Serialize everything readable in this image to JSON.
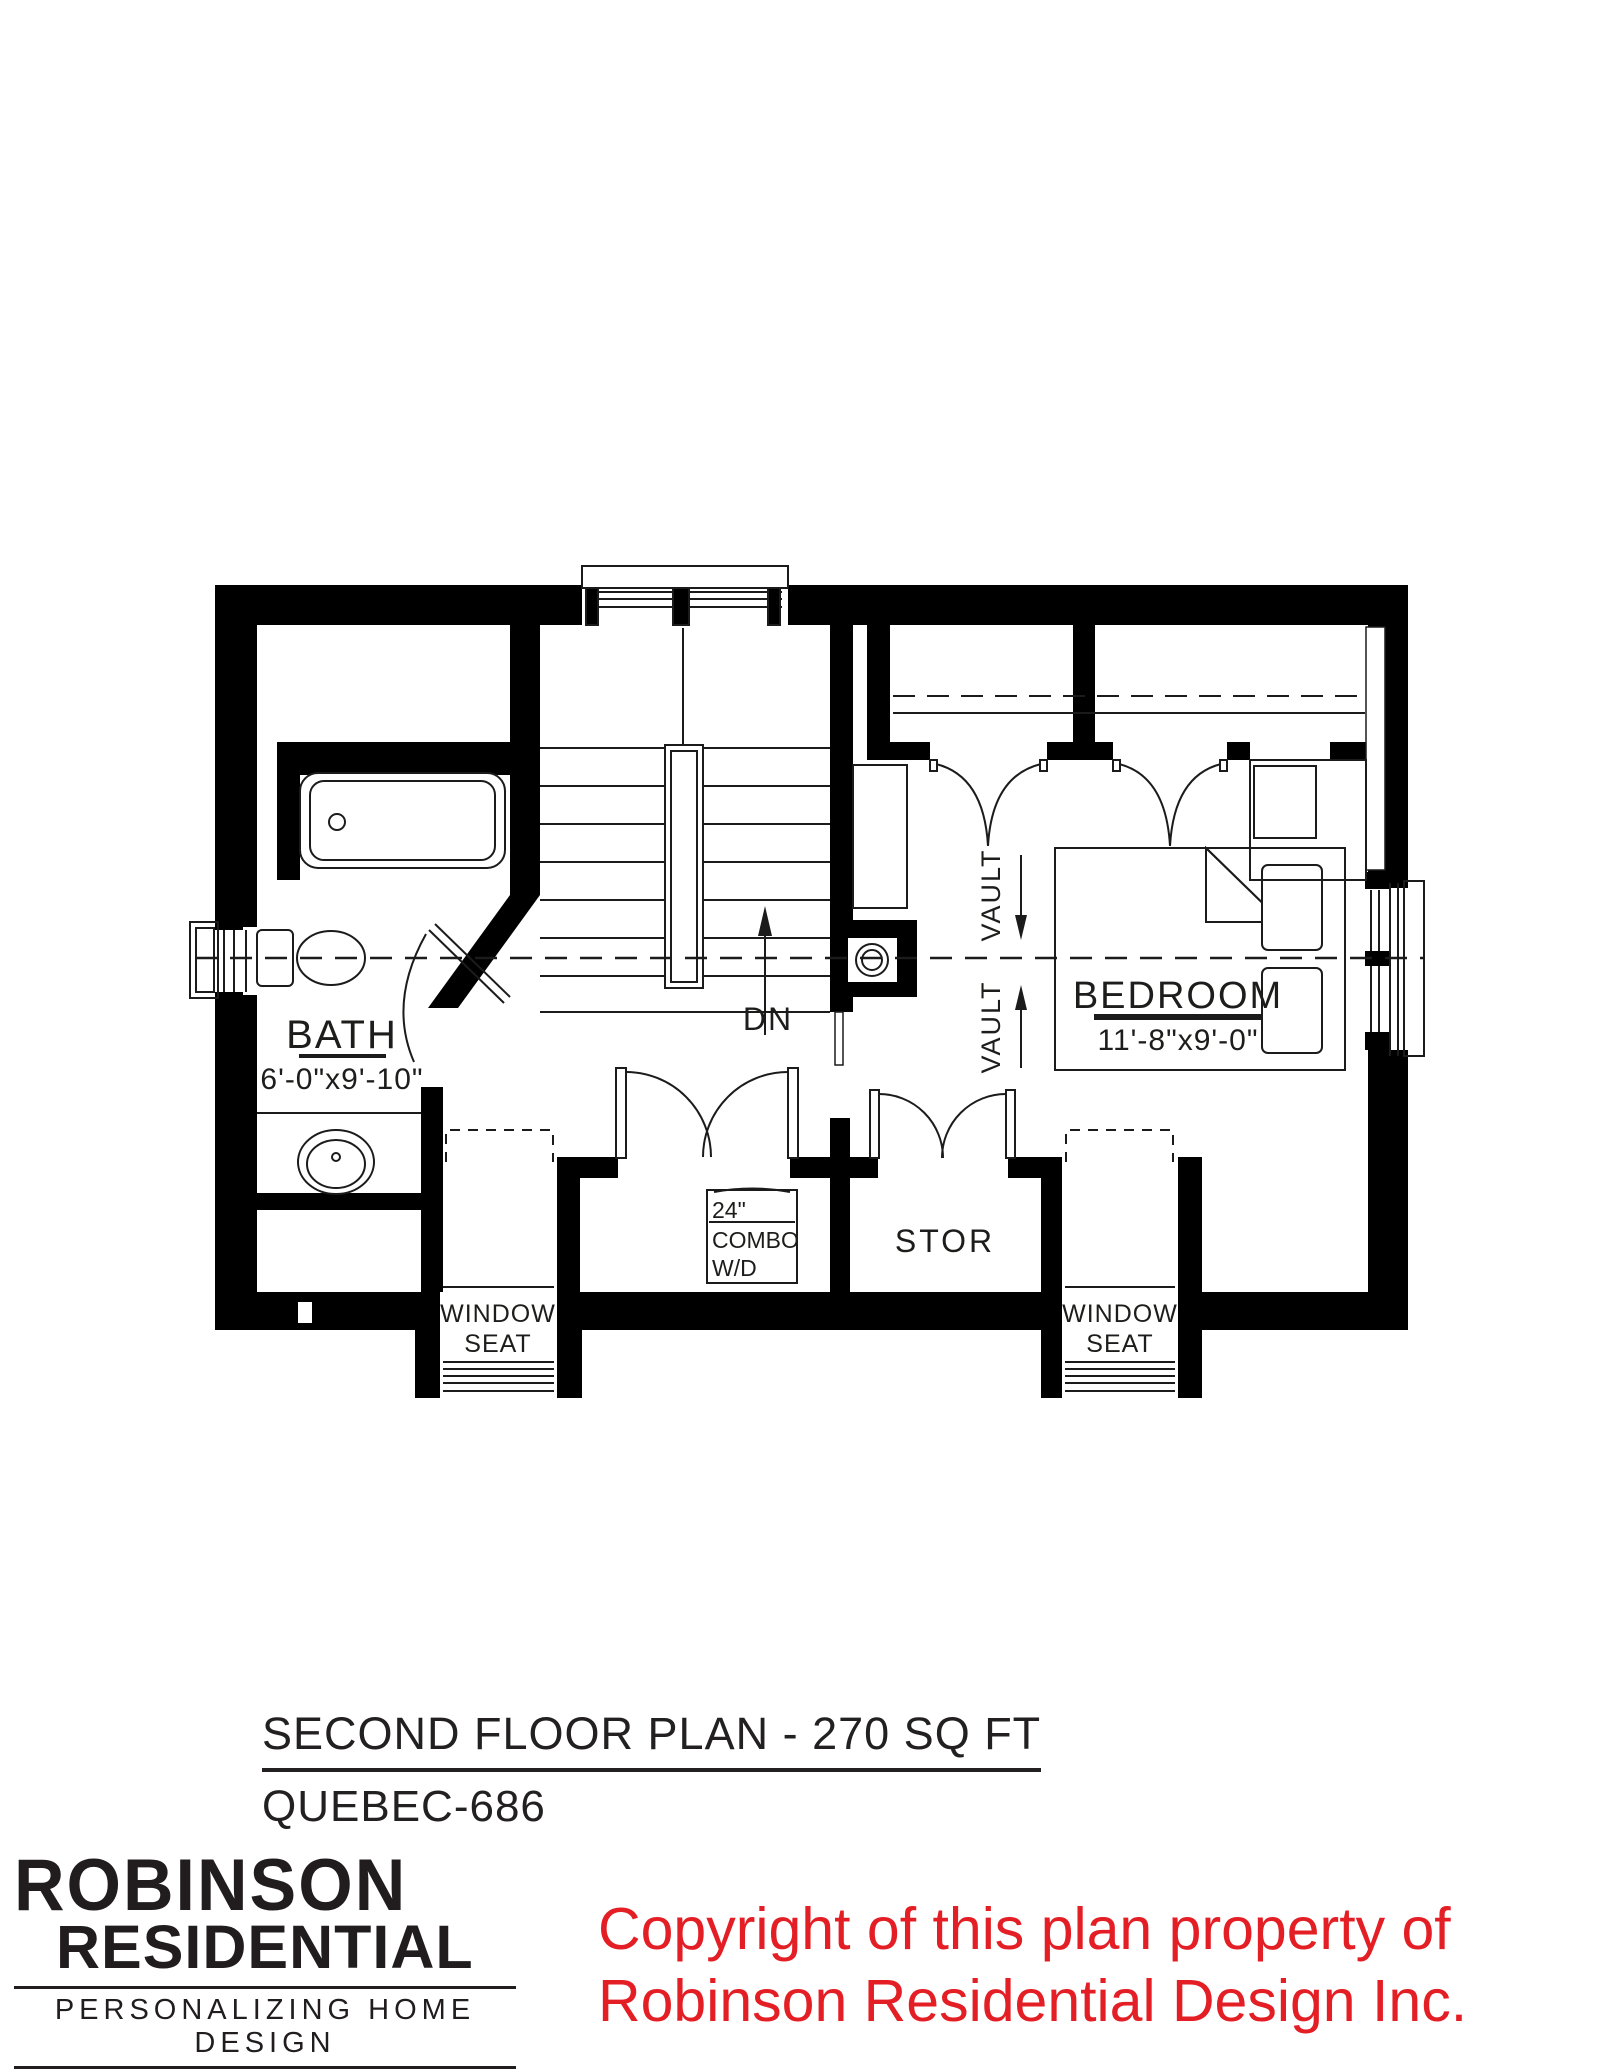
{
  "plan": {
    "rooms": {
      "bath": {
        "name": "BATH",
        "dims": "6'-0\"x9'-10\""
      },
      "bedroom": {
        "name": "BEDROOM",
        "dims": "11'-8\"x9'-0\""
      },
      "storage": {
        "name": "STOR"
      },
      "window_seat_left": {
        "line1": "WINDOW",
        "line2": "SEAT"
      },
      "window_seat_right": {
        "line1": "WINDOW",
        "line2": "SEAT"
      }
    },
    "appliances": {
      "washer_dryer": {
        "line1": "24\"",
        "line2": "COMBO",
        "line3": "W/D"
      }
    },
    "annotations": {
      "down": "DN",
      "vault_upper": "VAULT",
      "vault_lower": "VAULT"
    }
  },
  "title_block": {
    "title": "SECOND FLOOR PLAN - 270 SQ FT",
    "plan_number": "QUEBEC-686"
  },
  "logo": {
    "line1": "ROBINSON",
    "line2": "RESIDENTIAL",
    "tagline": "PERSONALIZING HOME DESIGN"
  },
  "copyright": {
    "line1": "Copyright of this plan property of",
    "line2": "Robinson Residential Design Inc.",
    "color": "#e41e25"
  },
  "colors": {
    "wall": "#000000",
    "ink": "#1b1b1b",
    "background": "#ffffff"
  }
}
